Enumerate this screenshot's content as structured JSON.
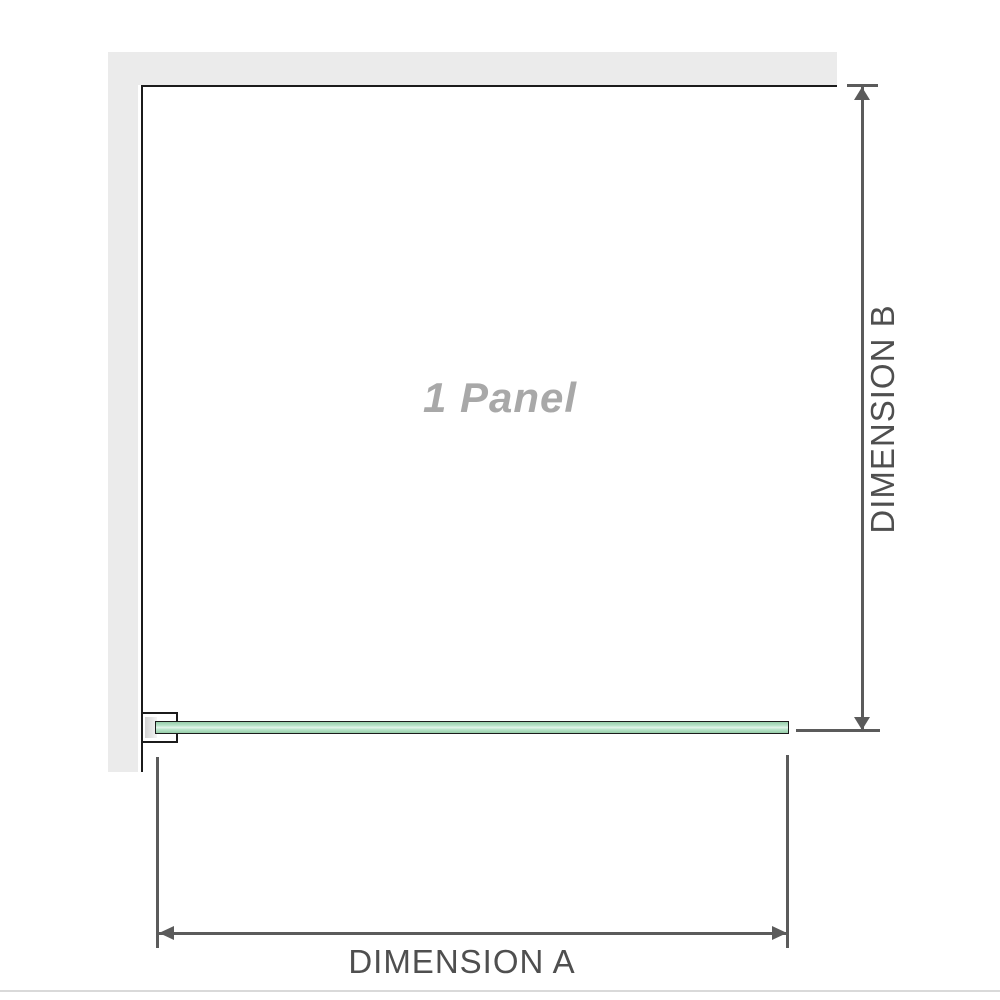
{
  "diagram": {
    "panel_label": "1 Panel",
    "dimension_a": {
      "label": "DIMENSION A"
    },
    "dimension_b": {
      "label": "DIMENSION B"
    }
  },
  "colors": {
    "wall_fill": "#ebebeb",
    "outline": "#1b1b1b",
    "glass_green": "#96cda9",
    "glass_green_mid": "#b9e4c9",
    "glass_green_light": "#e4f5eb",
    "dimension_line": "#5b5b5b",
    "dimension_text": "#4f4f4f",
    "panel_label_text": "#a8a8a8",
    "separator": "#d9d9d9",
    "bracket_pad": "#d2d2d2"
  }
}
